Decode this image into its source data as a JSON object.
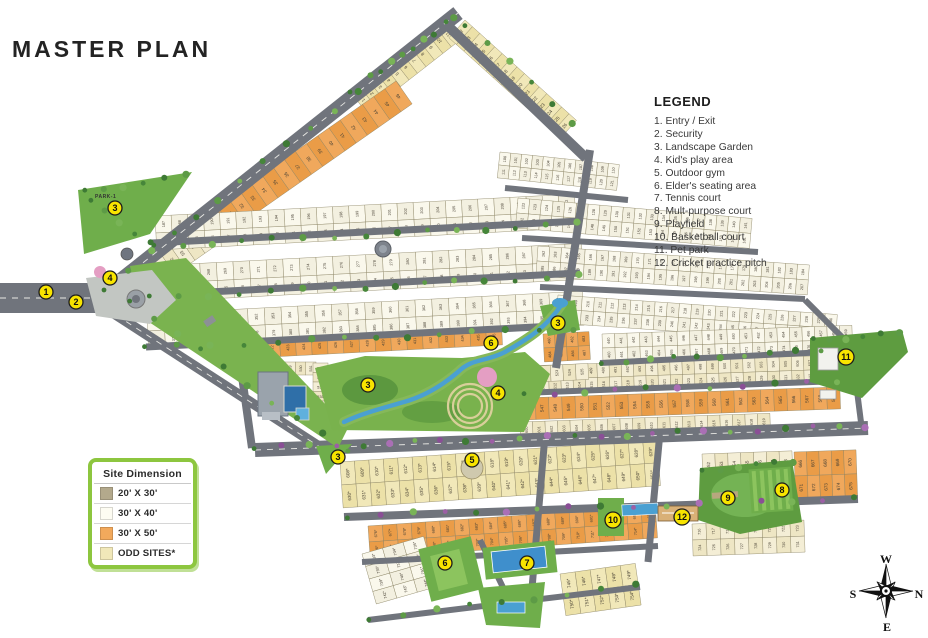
{
  "title": "MASTER PLAN",
  "legend": {
    "title": "LEGEND",
    "items": [
      "1. Entry / Exit",
      "2. Security",
      "3. Landscape Garden",
      "4. Kid's play area",
      "5. Outdoor gym",
      "6. Elder's seating area",
      "7. Tennis court",
      "8. Mult-purpose court",
      "9. Playfield",
      "10. Basketball court",
      "11. Pet park",
      "12. Cricket practice pitch"
    ]
  },
  "site_dimension": {
    "title": "Site  Dimension",
    "rows": [
      {
        "label": "20' X 30'",
        "color": "#b3a98c"
      },
      {
        "label": "30' X 40'",
        "color": "#fdfcf2"
      },
      {
        "label": "30' X 50'",
        "color": "#f2a95c"
      },
      {
        "label": "ODD SITES*",
        "color": "#f1e8b9"
      }
    ]
  },
  "compass": {
    "top": "W",
    "right": "N",
    "bottom": "E",
    "left": "S"
  },
  "park_label": "PARK-1",
  "colors": {
    "road": "#70747c",
    "road_dash": "#e8e8e4",
    "cream": [
      "#f4eed6",
      "#eee6c4"
    ],
    "white": [
      "#faf8ec",
      "#f3f0e0"
    ],
    "orange": [
      "#f0a85c",
      "#ea9c47"
    ],
    "odd": [
      "#f1e8b9",
      "#ece1a8"
    ],
    "plot_border": "#8a8363",
    "plot_number": "#4a4336",
    "green": "#6fae4b",
    "green_dark": "#55913c",
    "green_field": "#5e9c40",
    "water": "#4aa0d2",
    "marker_fill": "#f8e400",
    "marker_stroke": "#1c1c1c"
  },
  "map": {
    "blocks": [
      {
        "id": "strip-top-left",
        "x": 352,
        "y": 94,
        "rot": -38,
        "w": 118,
        "h": 24,
        "sub": 1,
        "cells": 11,
        "color": "odd",
        "start": 1
      },
      {
        "id": "strip-top-right",
        "x": 465,
        "y": 20,
        "rot": 42,
        "w": 150,
        "h": 24,
        "sub": 1,
        "cells": 15,
        "color": "odd",
        "start": 12
      },
      {
        "id": "strip-orange",
        "x": 206,
        "y": 214,
        "rot": -35,
        "w": 232,
        "h": 28,
        "sub": 1,
        "cells": 17,
        "color": "orange",
        "start": 30
      },
      {
        "id": "strip-lower",
        "x": 110,
        "y": 288,
        "rot": -35,
        "w": 110,
        "h": 26,
        "sub": 1,
        "cells": 9,
        "color": "cream",
        "start": 47
      },
      {
        "id": "grid-left-1",
        "x": 155,
        "y": 216,
        "rot": -3,
        "w": 420,
        "h": 34,
        "sub": 2,
        "cells": 26,
        "color": "white",
        "start": 187
      },
      {
        "id": "grid-left-2",
        "x": 150,
        "y": 266,
        "rot": -3,
        "w": 432,
        "h": 36,
        "sub": 2,
        "cells": 26,
        "color": "white",
        "start": 265
      },
      {
        "id": "grid-left-3",
        "x": 147,
        "y": 314,
        "rot": -3,
        "w": 436,
        "h": 34,
        "sub": 2,
        "cells": 26,
        "color": "white",
        "start": 346
      },
      {
        "id": "band-orange-mid",
        "x": 232,
        "y": 342,
        "rot": -3,
        "w": 270,
        "h": 17,
        "sub": 1,
        "cells": 17,
        "color": "orange",
        "start": 420
      },
      {
        "id": "block-orange-stream",
        "x": 543,
        "y": 334,
        "rot": -3,
        "w": 46,
        "h": 28,
        "sub": 2,
        "cells": 4,
        "color": "orange",
        "start": 480
      },
      {
        "id": "grid-ne-1",
        "x": 500,
        "y": 152,
        "rot": 6,
        "w": 120,
        "h": 26,
        "sub": 2,
        "cells": 11,
        "color": "white",
        "start": 100
      },
      {
        "id": "grid-ne-2",
        "x": 518,
        "y": 198,
        "rot": 5,
        "w": 235,
        "h": 30,
        "sub": 2,
        "cells": 20,
        "color": "white",
        "start": 122
      },
      {
        "id": "grid-ne-3",
        "x": 538,
        "y": 246,
        "rot": 4,
        "w": 272,
        "h": 30,
        "sub": 2,
        "cells": 23,
        "color": "white",
        "start": 162
      },
      {
        "id": "grid-ne-4",
        "x": 558,
        "y": 295,
        "rot": 4,
        "w": 280,
        "h": 28,
        "sub": 2,
        "cells": 23,
        "color": "white",
        "start": 208
      },
      {
        "id": "grid-e-1",
        "x": 602,
        "y": 334,
        "rot": -2,
        "w": 250,
        "h": 28,
        "sub": 2,
        "cells": 20,
        "color": "white",
        "start": 440
      },
      {
        "id": "grid-e-2",
        "x": 524,
        "y": 366,
        "rot": -2,
        "w": 316,
        "h": 28,
        "sub": 2,
        "cells": 26,
        "color": "cream",
        "start": 484
      },
      {
        "id": "grid-e-orange",
        "x": 522,
        "y": 398,
        "rot": -2,
        "w": 318,
        "h": 22,
        "sub": 1,
        "cells": 24,
        "color": "orange",
        "start": 546
      },
      {
        "id": "grid-e-3",
        "x": 520,
        "y": 422,
        "rot": -2,
        "w": 250,
        "h": 16,
        "sub": 1,
        "cells": 20,
        "color": "cream",
        "start": 600
      },
      {
        "id": "club-row",
        "x": 244,
        "y": 362,
        "rot": 0,
        "w": 72,
        "h": 13,
        "sub": 1,
        "cells": 7,
        "color": "cream",
        "start": 525
      },
      {
        "id": "club-col",
        "x": 313,
        "y": 363,
        "rot": 0,
        "w": 15,
        "h": 57,
        "sub": 1,
        "cells": 6,
        "dir": "v",
        "color": "cream",
        "start": 532
      },
      {
        "id": "row-519",
        "x": 500,
        "y": 368,
        "rot": -3,
        "w": 88,
        "h": 16,
        "sub": 1,
        "cells": 7,
        "color": "cream",
        "start": 519
      },
      {
        "id": "south-1",
        "x": 340,
        "y": 462,
        "rot": -4,
        "w": 318,
        "h": 46,
        "sub": 2,
        "cells": 22,
        "color": "odd",
        "start": 608,
        "sfx": "*"
      },
      {
        "id": "south-2",
        "x": 702,
        "y": 454,
        "rot": -2,
        "w": 90,
        "h": 48,
        "sub": 2,
        "cells": 7,
        "color": "cream",
        "start": 652
      },
      {
        "id": "south-2b",
        "x": 794,
        "y": 452,
        "rot": -2,
        "w": 62,
        "h": 48,
        "sub": 2,
        "cells": 5,
        "color": "orange",
        "start": 666
      },
      {
        "id": "south-orange",
        "x": 368,
        "y": 526,
        "rot": -4,
        "w": 288,
        "h": 32,
        "sub": 2,
        "cells": 20,
        "color": "orange",
        "start": 676,
        "sfx": "*"
      },
      {
        "id": "south-3",
        "x": 692,
        "y": 524,
        "rot": -2,
        "w": 112,
        "h": 32,
        "sub": 2,
        "cells": 8,
        "color": "cream",
        "start": 716
      },
      {
        "id": "tail-1",
        "x": 362,
        "y": 554,
        "rot": -16,
        "w": 64,
        "h": 52,
        "sub": 4,
        "cells": 3,
        "color": "white",
        "start": 733,
        "sfx": "*"
      },
      {
        "id": "tail-2",
        "x": 560,
        "y": 574,
        "rot": -8,
        "w": 76,
        "h": 42,
        "sub": 2,
        "cells": 5,
        "color": "odd",
        "start": 745,
        "sfx": "*"
      }
    ],
    "roads": [
      [
        0,
        298,
        98,
        298,
        30,
        1
      ],
      [
        96,
        300,
        458,
        13,
        15,
        1
      ],
      [
        448,
        26,
        586,
        158,
        10,
        0
      ],
      [
        96,
        302,
        340,
        460,
        10,
        1
      ],
      [
        152,
        243,
        580,
        221,
        7,
        0
      ],
      [
        149,
        295,
        580,
        273,
        7,
        0
      ],
      [
        146,
        347,
        575,
        325,
        7,
        0
      ],
      [
        590,
        150,
        556,
        368,
        8,
        0
      ],
      [
        505,
        188,
        628,
        200,
        6,
        0
      ],
      [
        522,
        238,
        758,
        252,
        6,
        0
      ],
      [
        540,
        287,
        805,
        299,
        6,
        0
      ],
      [
        600,
        363,
        848,
        351,
        6,
        0
      ],
      [
        521,
        393,
        840,
        381,
        6,
        0
      ],
      [
        255,
        450,
        868,
        428,
        14,
        1
      ],
      [
        344,
        517,
        858,
        499,
        8,
        0
      ],
      [
        545,
        435,
        530,
        612,
        7,
        0
      ],
      [
        660,
        432,
        648,
        562,
        7,
        0
      ],
      [
        362,
        562,
        658,
        546,
        6,
        0
      ],
      [
        368,
        620,
        640,
        587,
        6,
        0
      ],
      [
        480,
        540,
        512,
        606,
        6,
        0
      ],
      [
        852,
        352,
        862,
        430,
        6,
        0
      ],
      [
        240,
        362,
        252,
        448,
        8,
        0
      ],
      [
        805,
        300,
        850,
        345,
        6,
        0
      ]
    ],
    "greens": [
      {
        "id": "park-1",
        "pts": "78,190 192,172 150,234 84,254",
        "fill": "#6fae4b"
      },
      {
        "id": "entry-corridor",
        "pts": "130,266 186,258 348,428 338,448 140,316",
        "fill": "#7ab34f"
      },
      {
        "id": "central-garden",
        "pts": "315,368 365,356 462,358 525,352 550,374 524,432 332,430",
        "fill": "#79b24d"
      },
      {
        "id": "garden-triangle",
        "pts": "316,446 352,444 326,474",
        "fill": "#6fae4b"
      },
      {
        "id": "stream-head",
        "pts": "540,306 575,300 580,330 548,336",
        "fill": "#6fae4b"
      },
      {
        "id": "playfield",
        "pts": "700,468 792,460 802,522 740,534 698,520",
        "fill": "#5e9c40"
      },
      {
        "id": "pet-park",
        "pts": "810,338 902,330 908,352 862,398 810,382",
        "fill": "#5e9c40"
      },
      {
        "id": "pool-green",
        "pts": "478,588 545,582 540,628 486,625",
        "fill": "#6fae4b"
      }
    ],
    "tree_lines": [
      {
        "x1": 104,
        "y1": 288,
        "x2": 448,
        "y2": 20,
        "n": 16,
        "p": 0
      },
      {
        "x1": 128,
        "y1": 300,
        "x2": 346,
        "y2": 452,
        "n": 10,
        "p": 0
      },
      {
        "x1": 152,
        "y1": 246,
        "x2": 578,
        "y2": 224,
        "n": 15,
        "p": 0
      },
      {
        "x1": 149,
        "y1": 298,
        "x2": 578,
        "y2": 276,
        "n": 15,
        "p": 0
      },
      {
        "x1": 146,
        "y1": 348,
        "x2": 572,
        "y2": 328,
        "n": 14,
        "p": 0
      },
      {
        "x1": 256,
        "y1": 448,
        "x2": 864,
        "y2": 426,
        "n": 24,
        "p": 1
      },
      {
        "x1": 348,
        "y1": 516,
        "x2": 856,
        "y2": 498,
        "n": 17,
        "p": 1
      },
      {
        "x1": 600,
        "y1": 362,
        "x2": 844,
        "y2": 350,
        "n": 11,
        "p": 0
      },
      {
        "x1": 522,
        "y1": 394,
        "x2": 836,
        "y2": 382,
        "n": 11,
        "p": 1
      },
      {
        "x1": 84,
        "y1": 192,
        "x2": 186,
        "y2": 176,
        "n": 6,
        "p": 0
      },
      {
        "x1": 92,
        "y1": 202,
        "x2": 150,
        "y2": 242,
        "n": 5,
        "p": 0
      },
      {
        "x1": 352,
        "y1": 92,
        "x2": 452,
        "y2": 18,
        "n": 6,
        "p": 0
      },
      {
        "x1": 466,
        "y1": 24,
        "x2": 572,
        "y2": 122,
        "n": 6,
        "p": 0
      },
      {
        "x1": 368,
        "y1": 618,
        "x2": 636,
        "y2": 586,
        "n": 9,
        "p": 0
      },
      {
        "x1": 700,
        "y1": 470,
        "x2": 795,
        "y2": 462,
        "n": 6,
        "p": 0
      },
      {
        "x1": 812,
        "y1": 340,
        "x2": 900,
        "y2": 334,
        "n": 6,
        "p": 0
      }
    ],
    "markers": [
      {
        "n": "1",
        "x": 46,
        "y": 292
      },
      {
        "n": "2",
        "x": 76,
        "y": 302
      },
      {
        "n": "3",
        "x": 115,
        "y": 208
      },
      {
        "n": "3",
        "x": 368,
        "y": 385
      },
      {
        "n": "3",
        "x": 338,
        "y": 457
      },
      {
        "n": "3",
        "x": 558,
        "y": 323
      },
      {
        "n": "4",
        "x": 110,
        "y": 278
      },
      {
        "n": "4",
        "x": 498,
        "y": 393
      },
      {
        "n": "5",
        "x": 472,
        "y": 460
      },
      {
        "n": "6",
        "x": 491,
        "y": 343
      },
      {
        "n": "6",
        "x": 445,
        "y": 563
      },
      {
        "n": "7",
        "x": 527,
        "y": 563
      },
      {
        "n": "8",
        "x": 782,
        "y": 490
      },
      {
        "n": "9",
        "x": 728,
        "y": 498
      },
      {
        "n": "10",
        "x": 613,
        "y": 520
      },
      {
        "n": "11",
        "x": 846,
        "y": 357
      },
      {
        "n": "12",
        "x": 682,
        "y": 517
      }
    ]
  }
}
